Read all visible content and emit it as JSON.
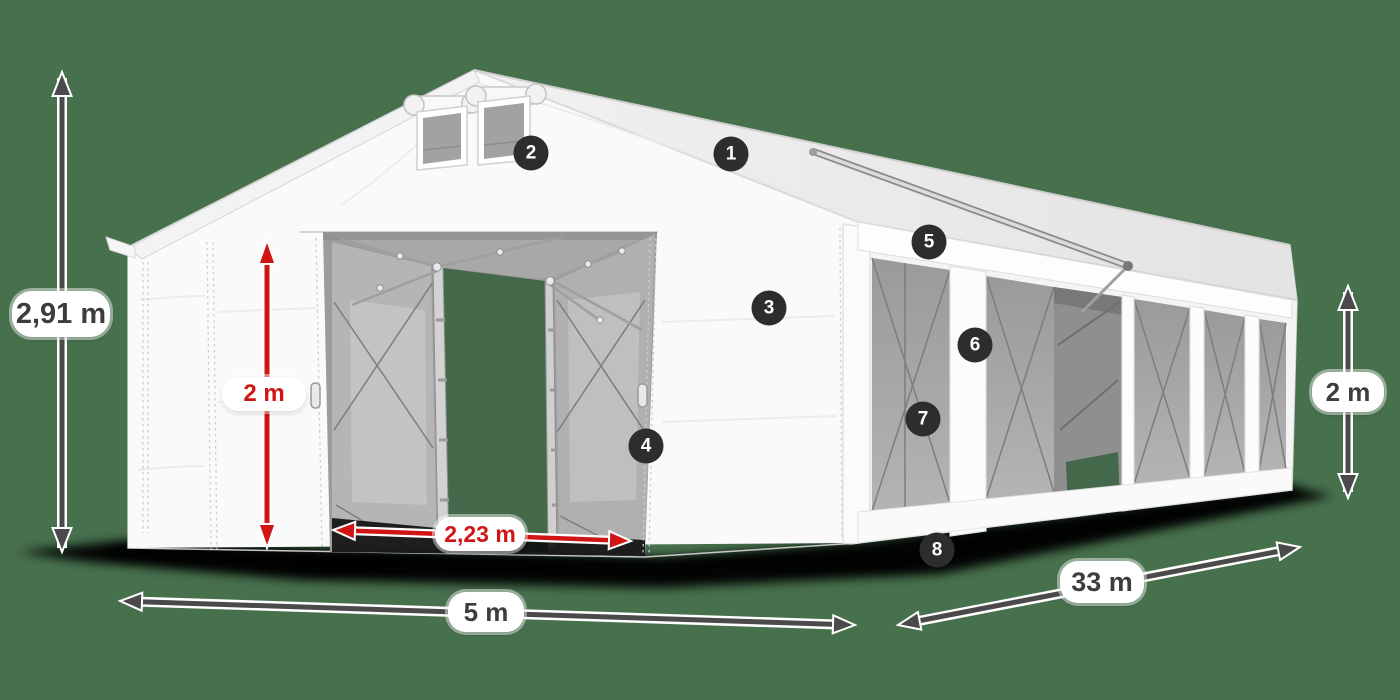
{
  "dimensions": {
    "total_height": {
      "value": "2,91 m"
    },
    "door_height": {
      "value": "2 m"
    },
    "door_width": {
      "value": "2,23 m"
    },
    "front_width": {
      "value": "5 m"
    },
    "length": {
      "value": "33 m"
    },
    "side_height": {
      "value": "2 m"
    }
  },
  "badges": [
    {
      "number": "1"
    },
    {
      "number": "2"
    },
    {
      "number": "3"
    },
    {
      "number": "4"
    },
    {
      "number": "5"
    },
    {
      "number": "6"
    },
    {
      "number": "7"
    },
    {
      "number": "8"
    }
  ],
  "colors": {
    "background": "#47704d",
    "accent_red": "#d11515",
    "arrow_dark": "#4a4a4a",
    "badge_background": "#2d2d2d",
    "tent_white": "#fafafa"
  }
}
